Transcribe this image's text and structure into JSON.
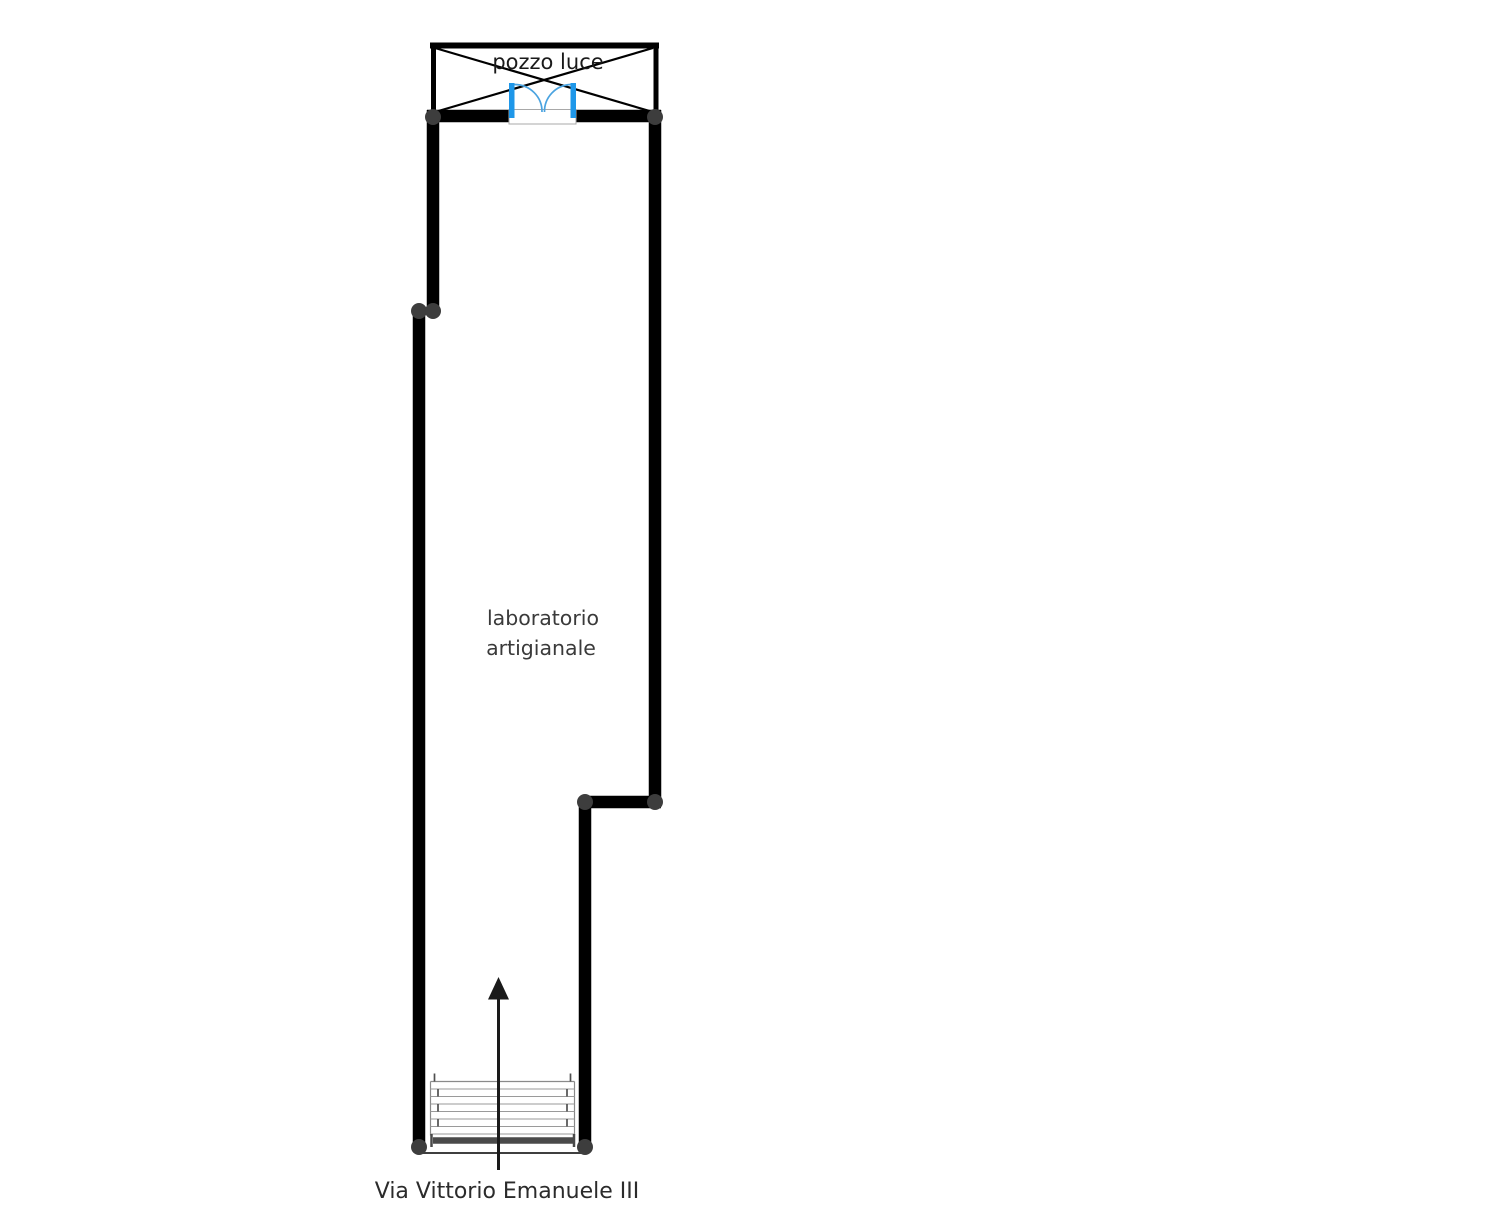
{
  "floorplan": {
    "pozzo_luce": {
      "label": "pozzo luce"
    },
    "room": {
      "label_line1": "laboratorio",
      "label_line2": "artigianale"
    },
    "street": {
      "label": "Via Vittorio Emanuele III"
    },
    "symbols": {
      "door": "double-swing-door-icon",
      "stairs": "staircase-icon",
      "arrow": "entrance-direction-arrow-icon",
      "light_well": "crossed-box-light-well-icon"
    },
    "colors": {
      "wall": "#000000",
      "joint": "#3d3d3d",
      "door_frame": "#1e97e9",
      "door_arc": "#4aa3e0",
      "stair_line": "#9a9a9a",
      "threshold": "#4a4a4a",
      "room_text": "#3a3a3a",
      "street_text": "#2b2b2b",
      "background": "#ffffff"
    }
  }
}
